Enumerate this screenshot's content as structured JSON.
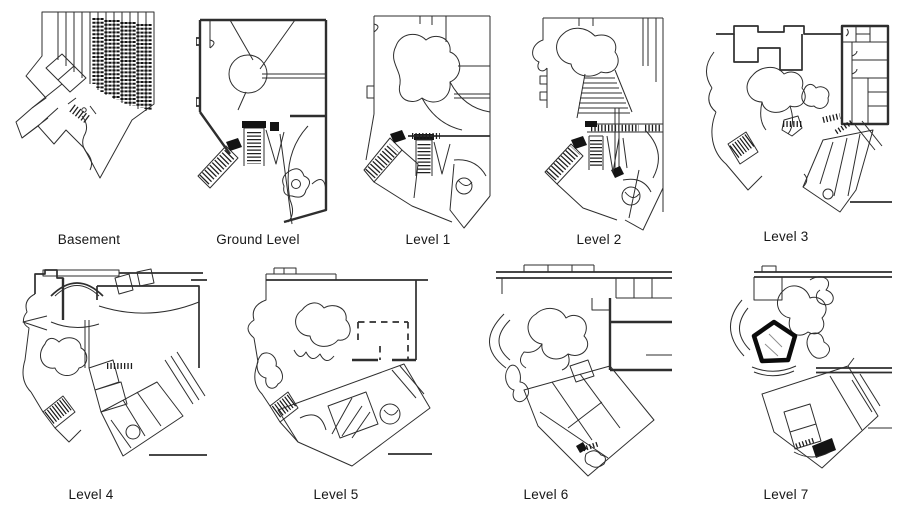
{
  "figure": {
    "description": "Nine architectural floor plans of one building, arranged in two rows",
    "background_color": "#ffffff",
    "line_color": "#2e2e2e",
    "rows": [
      5,
      4
    ],
    "plans": [
      {
        "id": "basement",
        "label": "Basement"
      },
      {
        "id": "ground-level",
        "label": "Ground Level"
      },
      {
        "id": "level-1",
        "label": "Level 1"
      },
      {
        "id": "level-2",
        "label": "Level 2"
      },
      {
        "id": "level-3",
        "label": "Level 3"
      },
      {
        "id": "level-4",
        "label": "Level 4"
      },
      {
        "id": "level-5",
        "label": "Level 5"
      },
      {
        "id": "level-6",
        "label": "Level 6"
      },
      {
        "id": "level-7",
        "label": "Level 7"
      }
    ]
  }
}
